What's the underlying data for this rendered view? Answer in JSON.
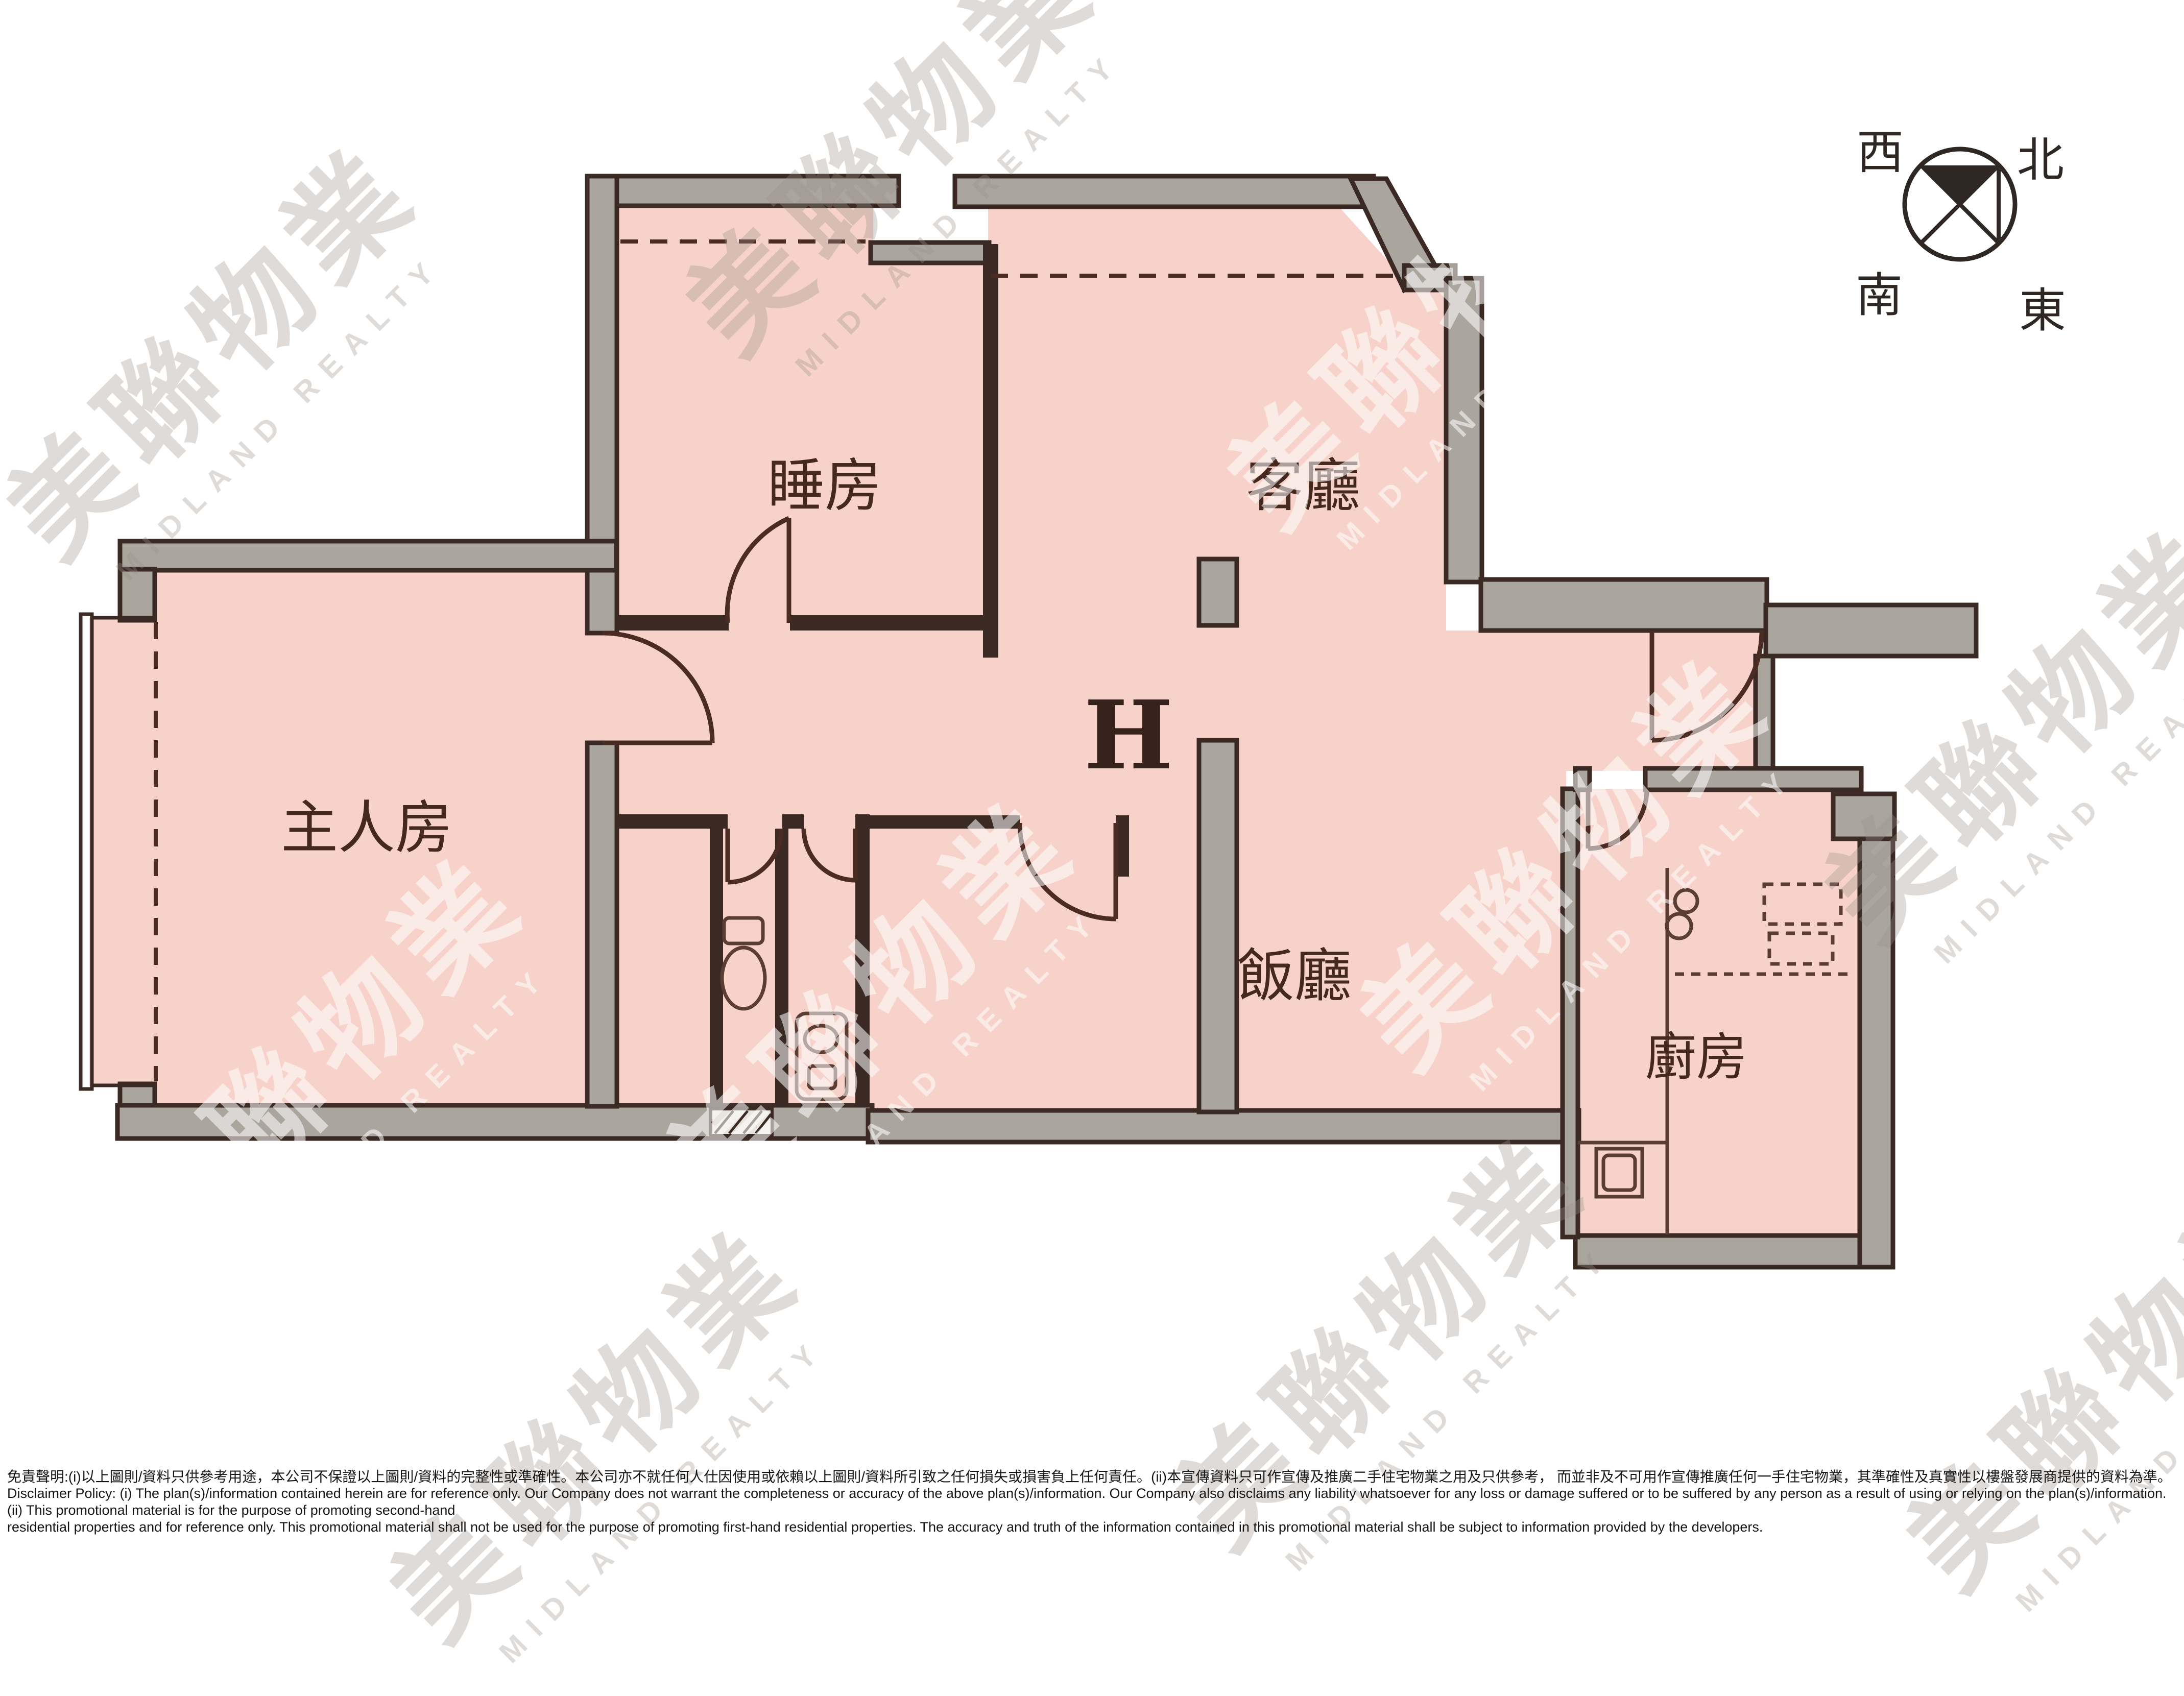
{
  "floor_plan": {
    "unit_label": "H",
    "rooms": [
      {
        "id": "master-bedroom",
        "label": "主人房"
      },
      {
        "id": "bedroom",
        "label": "睡房"
      },
      {
        "id": "living-room",
        "label": "客廳"
      },
      {
        "id": "dining-room",
        "label": "飯廳"
      },
      {
        "id": "kitchen",
        "label": "廚房"
      }
    ],
    "colors": {
      "room_fill": "#f7d2ca",
      "wall_gray": "#aaa59d",
      "wall_line": "#3a2a23",
      "label_text": "#45291f"
    }
  },
  "compass": {
    "west": "西",
    "north": "北",
    "south": "南",
    "east": "東"
  },
  "watermark": {
    "cjk": "美聯物業",
    "latin": "MIDLAND REALTY"
  },
  "disclaimer": {
    "line1_zh": "免責聲明:(i)以上圖則/資料只供參考用途，本公司不保證以上圖則/資料的完整性或準確性。本公司亦不就任何人仕因使用或依賴以上圖則/資料所引致之任何損失或損害負上任何責任。(ii)本宣傳資料只可作宣傳及推廣二手住宅物業之用及只供參考， 而並非及不可用作宣傳推廣任何一手住宅物業，其準確性及真實性以樓盤發展商提供的資料為準。",
    "line2_en": "Disclaimer Policy: (i) The plan(s)/information contained herein are for reference only. Our Company does not warrant the completeness or accuracy of the above plan(s)/information. Our Company also disclaims any liability whatsoever for any loss or damage suffered or to be suffered by any person as a result of using or relying on the plan(s)/information. (ii) This promotional material is for the purpose of promoting second-hand",
    "line3_en": "residential properties and for reference only. This promotional material shall not be used for the purpose of promoting first-hand residential properties. The accuracy and truth of the information contained in this promotional material shall be subject to information provided by the developers."
  }
}
